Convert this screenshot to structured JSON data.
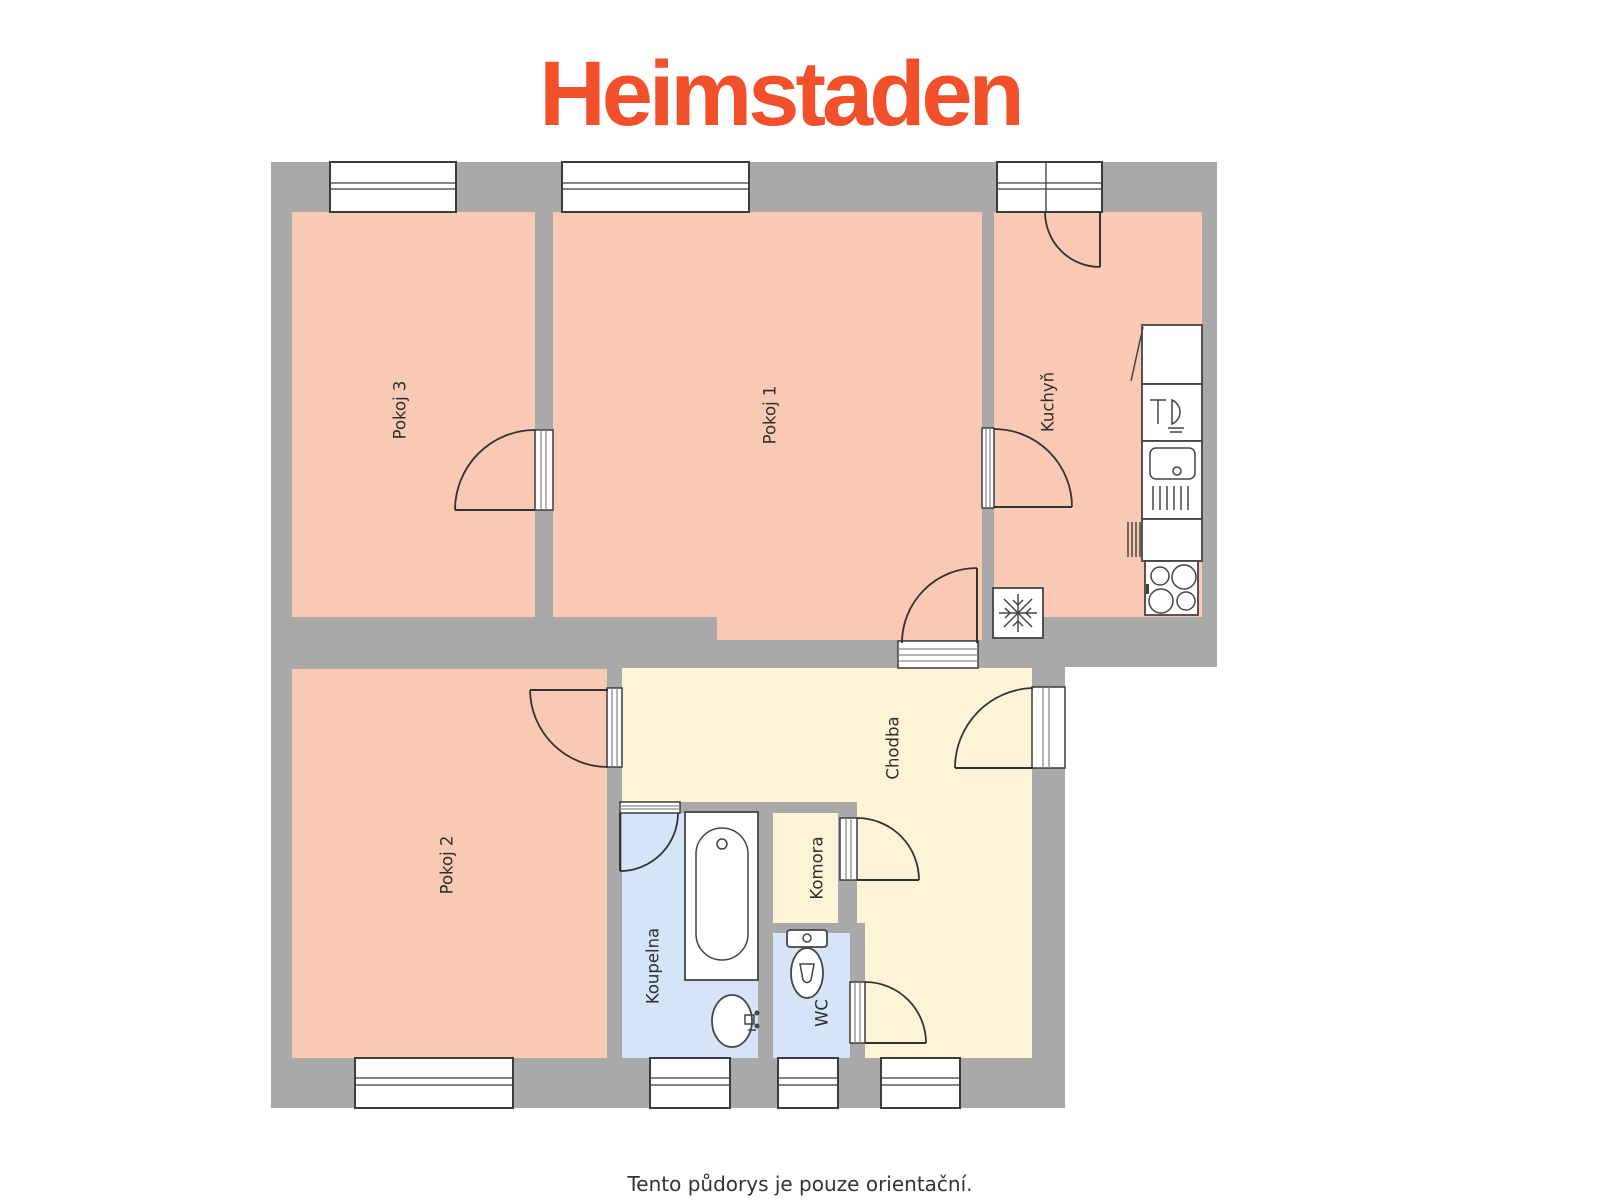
{
  "logo": {
    "text": "Heimstaden"
  },
  "disclaimer": {
    "text": "Tento půdorys je pouze orientační."
  },
  "rooms": {
    "pokoj1": "Pokoj 1",
    "pokoj2": "Pokoj 2",
    "pokoj3": "Pokoj 3",
    "kuchyn": "Kuchyň",
    "chodba": "Chodba",
    "komora": "Komora",
    "koupelna": "Koupelna",
    "wc": "WC"
  },
  "colors": {
    "logo_orange": "#F1502B",
    "wall_gray": "#A9A9A9",
    "room_floor_salmon": "#FAC9B3",
    "hall_floor_cream": "#FDF4D7",
    "bath_floor_blue": "#D6E4F7",
    "symbol_line_dark": "#3C3C3C",
    "text_dark": "#333333"
  },
  "icons": [
    "window-symbol",
    "door-arc-symbol",
    "door-sill-symbol",
    "freezer-snowflake-icon",
    "kitchen-cabinet-icon",
    "dishwasher-icon",
    "kitchen-sink-icon",
    "stove-burners-icon",
    "radiator-marks-icon",
    "bathtub-icon",
    "washbasin-icon",
    "toilet-icon"
  ]
}
